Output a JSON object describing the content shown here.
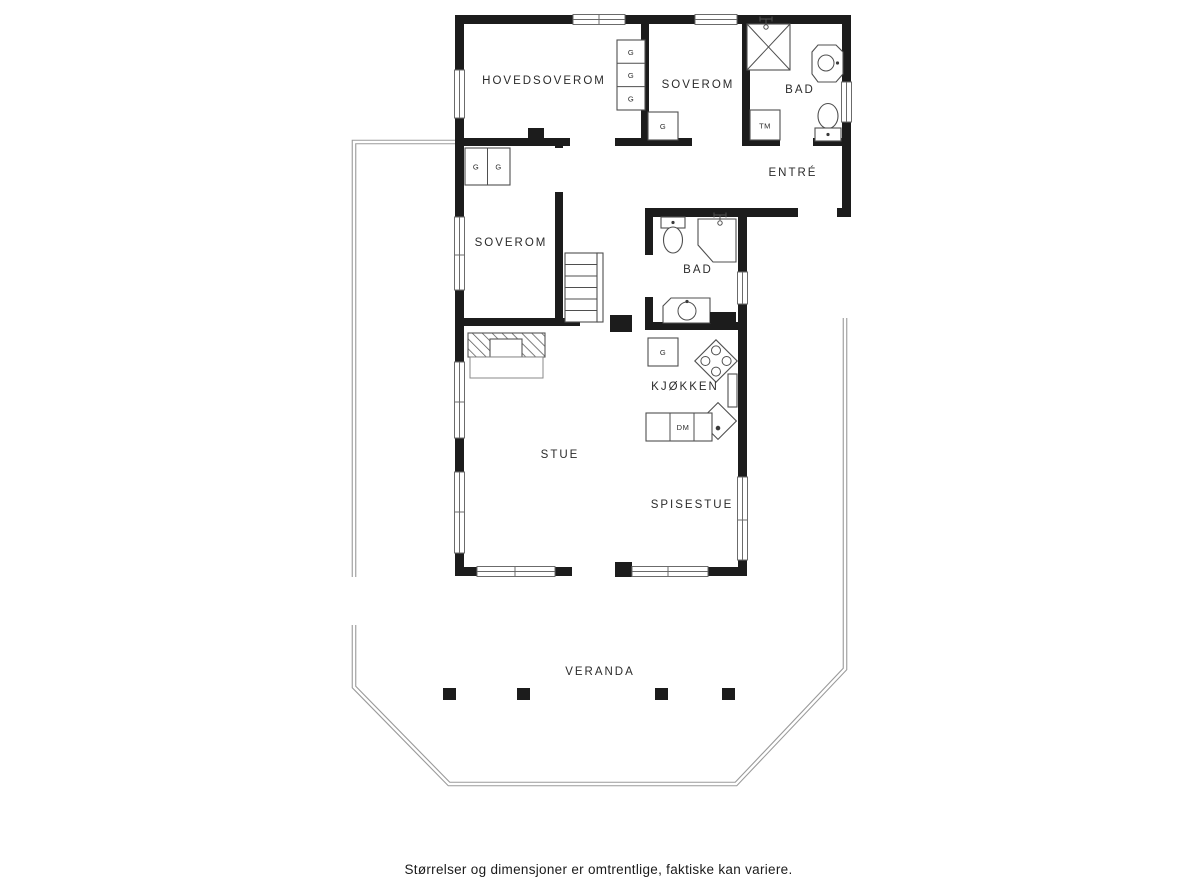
{
  "floorplan": {
    "rooms": {
      "hovedsoverom": "HOVEDSOVEROM",
      "soverom_top": "SOVEROM",
      "bad_top": "BAD",
      "entre": "ENTRÉ",
      "soverom_mid": "SOVEROM",
      "bad_mid": "BAD",
      "kjokken": "KJØKKEN",
      "stue": "STUE",
      "spisestue": "SPISESTUE",
      "veranda": "VERANDA"
    },
    "fixtures": {
      "wardrobe": "G",
      "washing_machine": "TM",
      "dishwasher": "DM"
    },
    "caption": "Størrelser og dimensjoner er omtrentlige, faktiske kan variere.",
    "colors": {
      "wall": "#1c1c1c",
      "fixture_outline": "#4f4f4f",
      "railing": "#9a9a9a",
      "label": "#2b2b2b"
    }
  }
}
